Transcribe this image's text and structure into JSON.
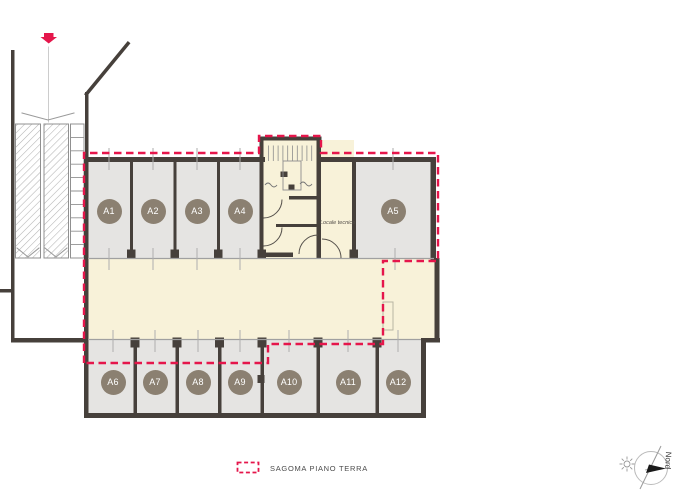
{
  "drawing": {
    "type": "basement-floor-plan",
    "units": [
      {
        "label": "A1",
        "x": 109,
        "y": 211
      },
      {
        "label": "A2",
        "x": 153,
        "y": 211
      },
      {
        "label": "A3",
        "x": 197,
        "y": 211
      },
      {
        "label": "A4",
        "x": 240,
        "y": 211
      },
      {
        "label": "A5",
        "x": 393,
        "y": 211
      },
      {
        "label": "A6",
        "x": 113,
        "y": 382
      },
      {
        "label": "A7",
        "x": 155,
        "y": 382
      },
      {
        "label": "A8",
        "x": 198,
        "y": 382
      },
      {
        "label": "A9",
        "x": 240,
        "y": 382
      },
      {
        "label": "A10",
        "x": 289,
        "y": 382
      },
      {
        "label": "A11",
        "x": 348,
        "y": 382
      },
      {
        "label": "A12",
        "x": 398,
        "y": 382
      }
    ],
    "room_labels": {
      "locale_tecnico": "Locale tecnico"
    }
  },
  "legend": {
    "sagoma_label": "SAGOMA PIANO TERRA"
  },
  "compass": {
    "north_label": "Nord"
  },
  "icons": {
    "entry_arrow": "red-down-arrow-ramp-entry",
    "legend_swatch": "red-dashed-outline-rect",
    "compass": "north-compass-with-sun"
  },
  "colors": {
    "background": "#ffffff",
    "wall": "#46403b",
    "unit_floor": "#e5e4e2",
    "circulation_floor": "#f8f2d9",
    "badge": "#8b8071",
    "badge_text": "#ffffff",
    "sagoma_red": "#e5164b"
  }
}
